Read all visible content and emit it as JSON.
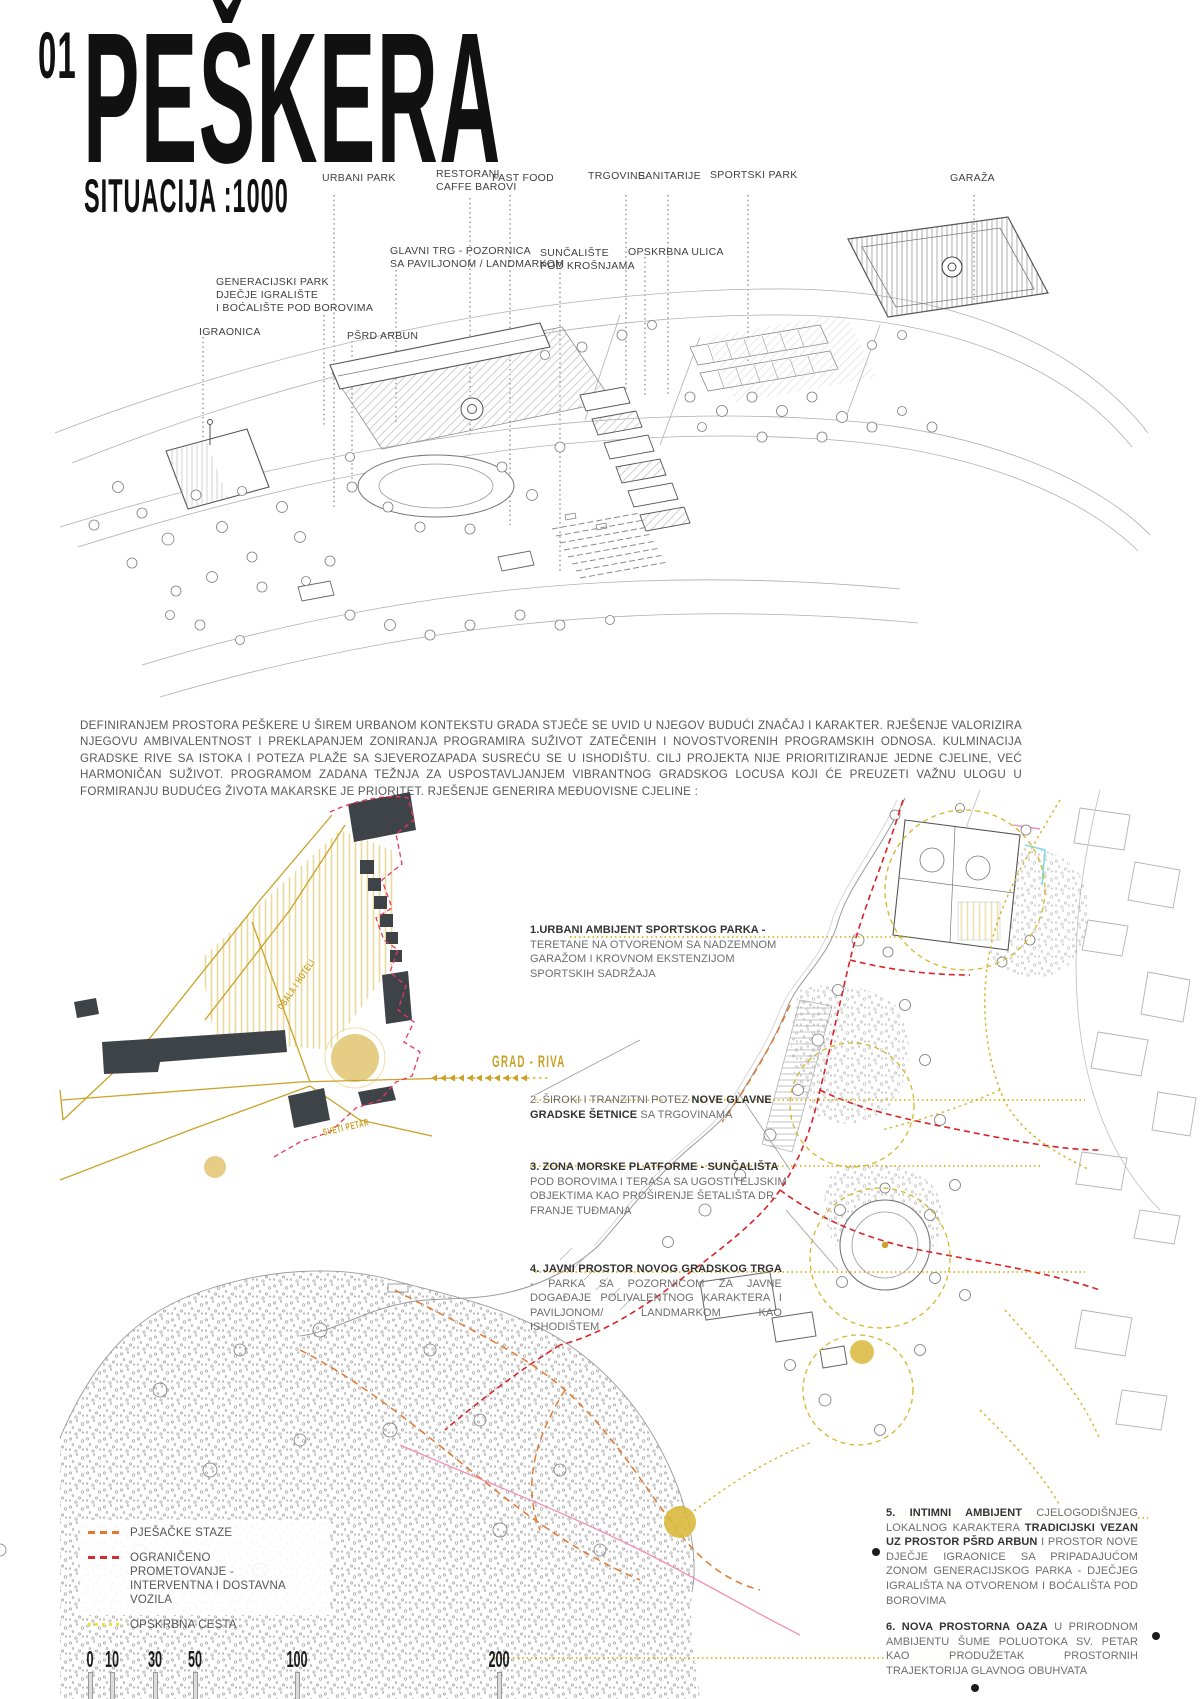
{
  "header": {
    "number": "01",
    "title": "PEŠKERA",
    "subtitle": "SITUACIJA :1000"
  },
  "axon_labels": {
    "urbani_park": "URBANI PARK",
    "restorani": [
      "RESTORANI",
      "CAFFE BAROVI"
    ],
    "fast_food": "FAST FOOD",
    "trgovine": "TRGOVINE",
    "sanitarije": "SANITARIJE",
    "sportski_park": "SPORTSKI PARK",
    "garaza": "GARAŽA",
    "glavni_trg": [
      "GLAVNI TRG - POZORNICA",
      "SA PAVILJONOM / LANDMARKOM"
    ],
    "suncaliste": [
      "SUNČALIŠTE",
      "POD KROŠNJAMA"
    ],
    "opskrbna_ulica": "OPSKRBNA ULICA",
    "generacijski_park": [
      "GENERACIJSKI PARK",
      "DJEČJE IGRALIŠTE",
      "I BOĆALIŠTE POD BOROVIMA"
    ],
    "igraonica": "IGRAONICA",
    "psrd_arbun": "PŠRD ARBUN"
  },
  "intro": {
    "text": "DEFINIRANJEM PROSTORA PEŠKERE U ŠIREM URBANOM KONTEKSTU GRADA STJEČE SE UVID U NJEGOV BUDUĆI ZNAČAJ I KARAKTER. RJEŠENJE VALORIZIRA NJEGOVU AMBIVALENTNOST I PREKLAPANJEM ZONIRANJA PROGRAMIRA SUŽIVOT ZATEČENIH I NOVOSTVORENIH PROGRAMSKIH ODNOSA. KULMINACIJA GRADSKE RIVE SA ISTOKA I POTEZA PLAŽE SA SJEVEROZAPADA SUSREĆU SE U ISHODIŠTU. CILJ PROJEKTA NIJE PRIORITIZIRANJE JEDNE CJELINE, VEĆ HARMONIČAN SUŽIVOT. PROGRAMOM ZADANA TEŽNJA ZA USPOSTAVLJANJEM VIBRANTNOG GRADSKOG LOCUSA KOJI ĆE PREUZETI VAŽNU ULOGU U FORMIRANJU BUDUĆEG ŽIVOTA MAKARSKE JE PRIORITET. RJEŠENJE GENERIRA MEĐUOVISNE CJELINE :"
  },
  "annotations": [
    {
      "segments": [
        {
          "t": "1.URBANI AMBIJENT SPORTSKOG PARKA - ",
          "b": true
        },
        {
          "t": "TERETANE NA OTVORENOM SA NADZEMNOM GARAŽOM I KROVNOM EKSTENZIJOM SPORTSKIH SADRŽAJA",
          "b": false
        }
      ]
    },
    {
      "segments": [
        {
          "t": "2. ",
          "b": false
        },
        {
          "t": "ŠIROKI I TRANZITNI POTEZ ",
          "b": false
        },
        {
          "t": "NOVE GLAVNE GRADSKE ŠETNICE ",
          "b": true
        },
        {
          "t": "SA TRGOVINAMA",
          "b": false
        }
      ]
    },
    {
      "segments": [
        {
          "t": "3. ZONA MORSKE PLATFORME - SUNČALIŠTA ",
          "b": true
        },
        {
          "t": "POD BOROVIMA I TERASA SA UGOSTITELJSKIM OBJEKTIMA KAO PROŠIRENJE ŠETALIŠTA DR. FRANJE TUĐMANA",
          "b": false
        }
      ]
    },
    {
      "segments": [
        {
          "t": "4. JAVNI PROSTOR NOVOG GRADSKOG TRGA",
          "b": true
        },
        {
          "t": " - PARKA SA POZORNICOM ZA JAVNE DOGAĐAJE POLIVALENTNOG KARAKTERA I PAVILJONOM/ LANDMARKOM KAO ISHODIŠTEM",
          "b": false
        }
      ]
    },
    {
      "segments": [
        {
          "t": "5. INTIMNI AMBIJENT ",
          "b": true
        },
        {
          "t": "CJELOGODIŠNJEG LOKALNOG KARAKTERA ",
          "b": false
        },
        {
          "t": "TRADICIJSKI VEZAN UZ PROSTOR PŠRD ARBUN",
          "b": true
        },
        {
          "t": " I PROSTOR NOVE DJEČJE IGRAONICE SA PRIPADAJUĆOM ZONOM GENERACIJSKOG PARKA - DJEČJEG IGRALIŠTA NA OTVORENOM I BOĆALIŠTA POD BOROVIMA",
          "b": false
        }
      ]
    },
    {
      "segments": [
        {
          "t": "6. NOVA PROSTORNA OAZA",
          "b": true
        },
        {
          "t": " U PRIRODNOM AMBIJENTU ŠUME POLUOTOKA SV. PETAR KAO PRODUŽETAK PROSTORNIH TRAJEKTORIJA GLAVNOG OBUHVATA",
          "b": false
        }
      ]
    }
  ],
  "map_labels": {
    "grad_riva": "GRAD - RIVA",
    "obala_hoteli": "OBALA I HOTELI",
    "sveti_petar": "SVETI PETAR"
  },
  "legend": {
    "items": [
      {
        "label": "PJEŠAČKE STAZE",
        "color": "#E2782F",
        "style": "dashed"
      },
      {
        "label": "OGRANIČENO PROMETOVANJE - INTERVENTNA I DOSTAVNA VOZILA",
        "color": "#D42A2A",
        "style": "dashed"
      },
      {
        "label": "OPSKRBNA CESTA",
        "color": "#E8E337",
        "style": "dotted"
      }
    ]
  },
  "scale_bar": {
    "ticks": [
      "0",
      "10",
      "30",
      "50",
      "100",
      "200"
    ]
  },
  "colors": {
    "gold": "#C9A227",
    "gold_fill": "#E3C878",
    "red": "#D8232A",
    "red_pink": "#E8365E",
    "orange": "#E2782F",
    "yellow": "#E8E337",
    "pink": "#F290B8",
    "cyan": "#7FD9E8",
    "slate_building": "#3E4347",
    "line_gray": "#9a9a9a",
    "text_gray": "#585858"
  }
}
